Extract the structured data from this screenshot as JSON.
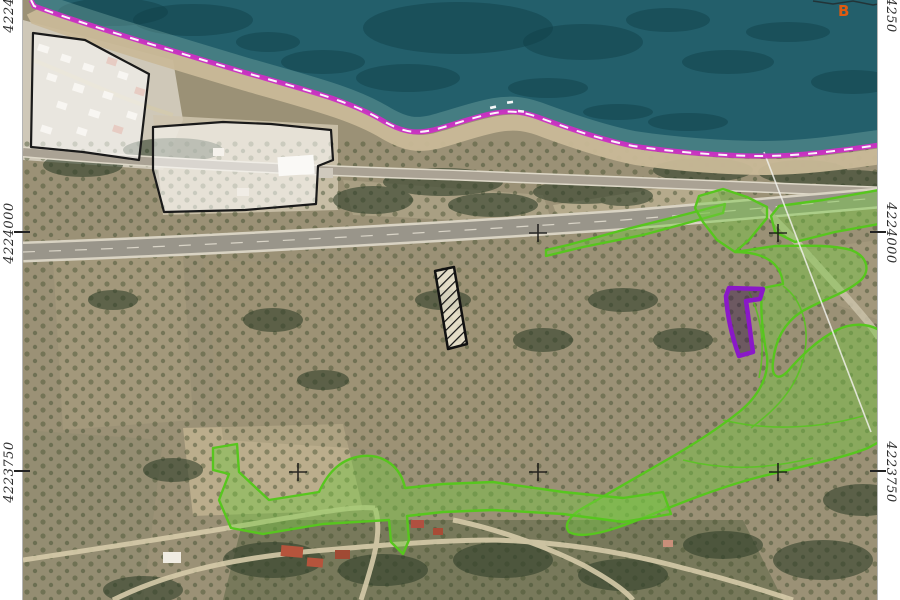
{
  "page": {
    "title": "Orthophoto map sheet with planning overlays"
  },
  "grid": {
    "left_labels": [
      "4224250",
      "4224000",
      "4223750"
    ],
    "right_labels": [
      "4224250",
      "4224000",
      "4223750"
    ]
  },
  "annotations": {
    "b_label": "B"
  },
  "colors": {
    "sea-deep": "#235f6b",
    "sea-dark": "#0f3d47",
    "sea-shallow": "#79aba4",
    "beach": "#c9b998",
    "land": "#9b9176",
    "overlay-white-fill": "rgba(255,255,255,0.55)",
    "overlay-outline": "#1a1a1a",
    "green-fill": "rgba(118,200,66,0.45)",
    "green-stroke": "#57c61e",
    "purple-stroke": "#8a18c8",
    "purple-fill": "rgba(45,12,70,0.42)",
    "magenta-line": "#cc2fc4",
    "label-color": "#2f2f2f",
    "b-color": "#e05a10"
  },
  "features": {
    "shoreline_boundary": "magenta dashed line along coast",
    "white_masked_parcels": 2,
    "green_overlay_zones": "vegetated parcels along road and hillside",
    "purple_parcel": 1,
    "hatched_strip_parcel": 1,
    "grid_interval_m": 250
  }
}
